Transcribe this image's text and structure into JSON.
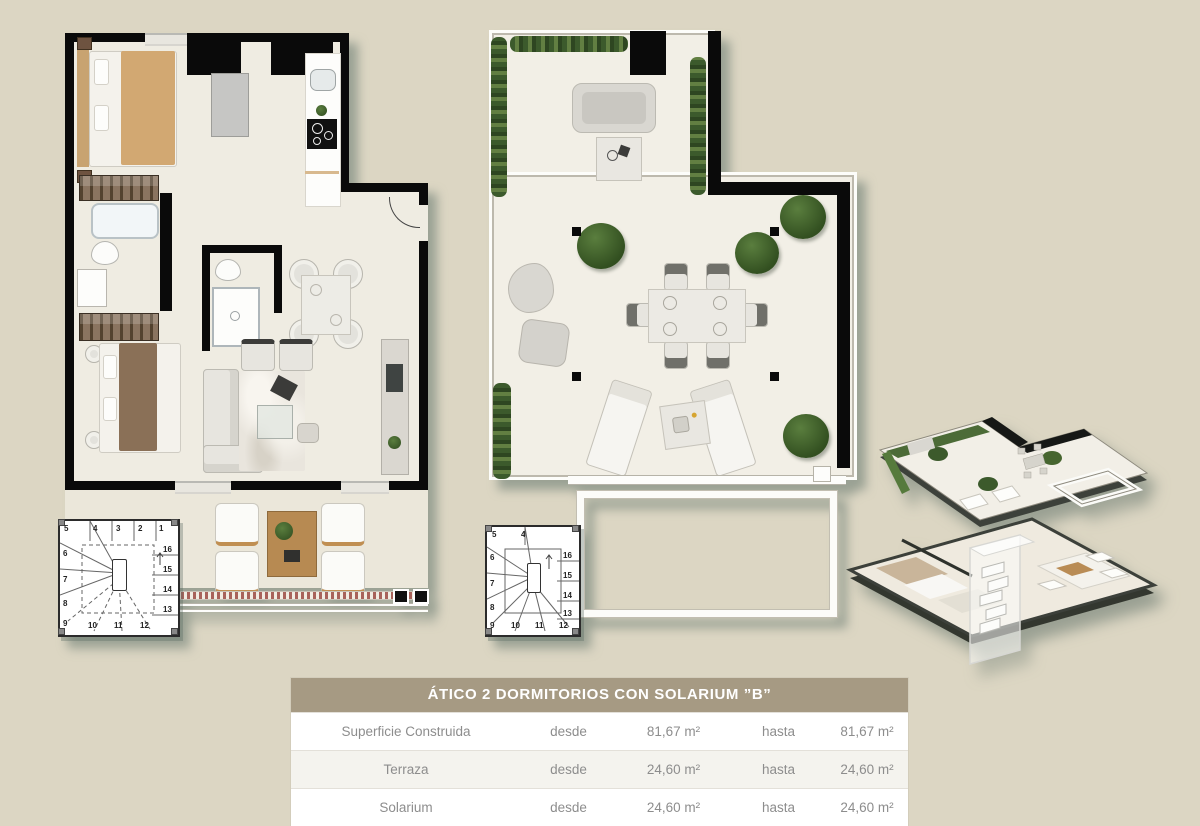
{
  "page": {
    "background_color": "#dcd6c3",
    "description": "Penthouse floor plan sheet with 2D apartment plan, solarium plan, 3D exploded view and surface table"
  },
  "colors": {
    "wall": "#0a0a0a",
    "floor": "#efece2",
    "plant_green": "#3c5a2c",
    "table_header_bg": "#a69a83",
    "table_row_alt_bg": "#f4f3ee",
    "table_text": "#8d8d8d"
  },
  "plans": {
    "left": {
      "name": "apartment-floor-plan",
      "stairs": {
        "top": [
          "4",
          "3",
          "2",
          "1"
        ],
        "left": [
          "5",
          "6",
          "7",
          "8",
          "9"
        ],
        "bottom": [
          "10",
          "11",
          "12"
        ],
        "right": [
          "16",
          "15",
          "14",
          "13"
        ]
      }
    },
    "middle": {
      "name": "solarium-floor-plan",
      "stairs": {
        "top": [
          "5",
          "4"
        ],
        "left": [
          "6",
          "7",
          "8",
          "9"
        ],
        "bottom": [
          "10",
          "11",
          "12"
        ],
        "right": [
          "16",
          "15",
          "14",
          "13"
        ]
      }
    },
    "right": {
      "name": "3d-exploded-view"
    }
  },
  "spec_table": {
    "title": "ÁTICO 2 DORMITORIOS CON SOLARIUM ”B”",
    "rows": [
      {
        "label": "Superficie Construida",
        "from_label": "desde",
        "from_value": "81,67 m²",
        "to_label": "hasta",
        "to_value": "81,67 m²"
      },
      {
        "label": "Terraza",
        "from_label": "desde",
        "from_value": "24,60 m²",
        "to_label": "hasta",
        "to_value": "24,60 m²"
      },
      {
        "label": "Solarium",
        "from_label": "desde",
        "from_value": "24,60 m²",
        "to_label": "hasta",
        "to_value": "24,60 m²"
      }
    ]
  }
}
